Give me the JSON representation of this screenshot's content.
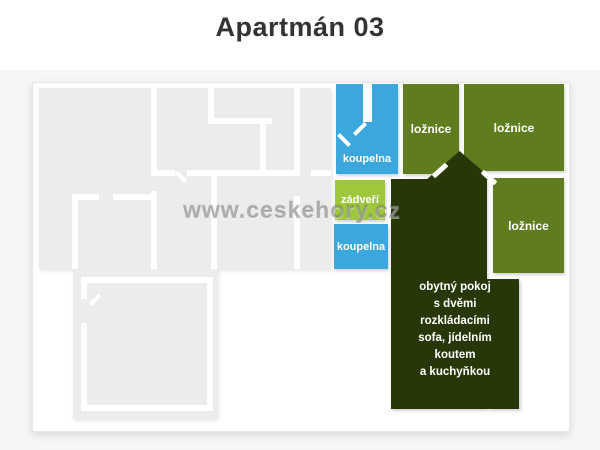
{
  "title": "Apartmán 03",
  "watermark": "www.ceskehory.cz",
  "rooms": {
    "koupelna_top": "koupelna",
    "zadveri": "zádveří",
    "koupelna_bottom": "koupelna",
    "loznice_1": "ložnice",
    "loznice_2": "ložnice",
    "loznice_3": "ložnice",
    "living": "obytný pokoj\ns dvěmi\nrozkládacími\nsofa, jídelním\nkoutem\na kuchyňkou"
  },
  "colors": {
    "bathroom_blue": "#3aa8dc",
    "hall_lime": "#9fc73c",
    "bedroom_olive": "#5f7d1e",
    "living_dark": "#273708",
    "plan_gray": "#ececec",
    "wall_white": "#ffffff",
    "title_text": "#333333",
    "page_bg": "#f6f6f6",
    "card_bg": "#ffffff"
  }
}
